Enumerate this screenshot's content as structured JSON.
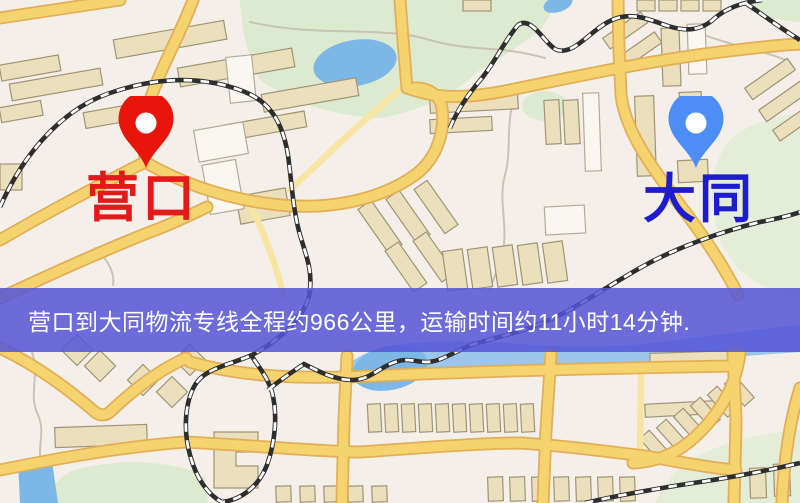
{
  "banner": {
    "text": "营口到大同物流专线全程约966公里，运输时间约11小时14分钟.",
    "background_color": "#5454d6",
    "text_color": "#ffffff"
  },
  "route": {
    "origin": "营口",
    "destination": "大同",
    "distance_km": 966,
    "duration_text": "11小时14分钟"
  },
  "markers": {
    "origin": {
      "label": "营口",
      "pin_color": "#e9150a",
      "label_color": "#e31a1a"
    },
    "destination": {
      "label": "大同",
      "pin_color": "#4d8df6",
      "label_color": "#1d1dcd"
    }
  },
  "map_colors": {
    "background": "#f4efe8",
    "road_major": "#f5d36e",
    "road_border": "#e2ae57",
    "road_minor": "#f8e5a3",
    "park": "#dcead0",
    "water": "#7db7e8",
    "railway": "#2e2e2e",
    "building_fill": "#ebdfbc",
    "building_stroke": "#a09478"
  }
}
